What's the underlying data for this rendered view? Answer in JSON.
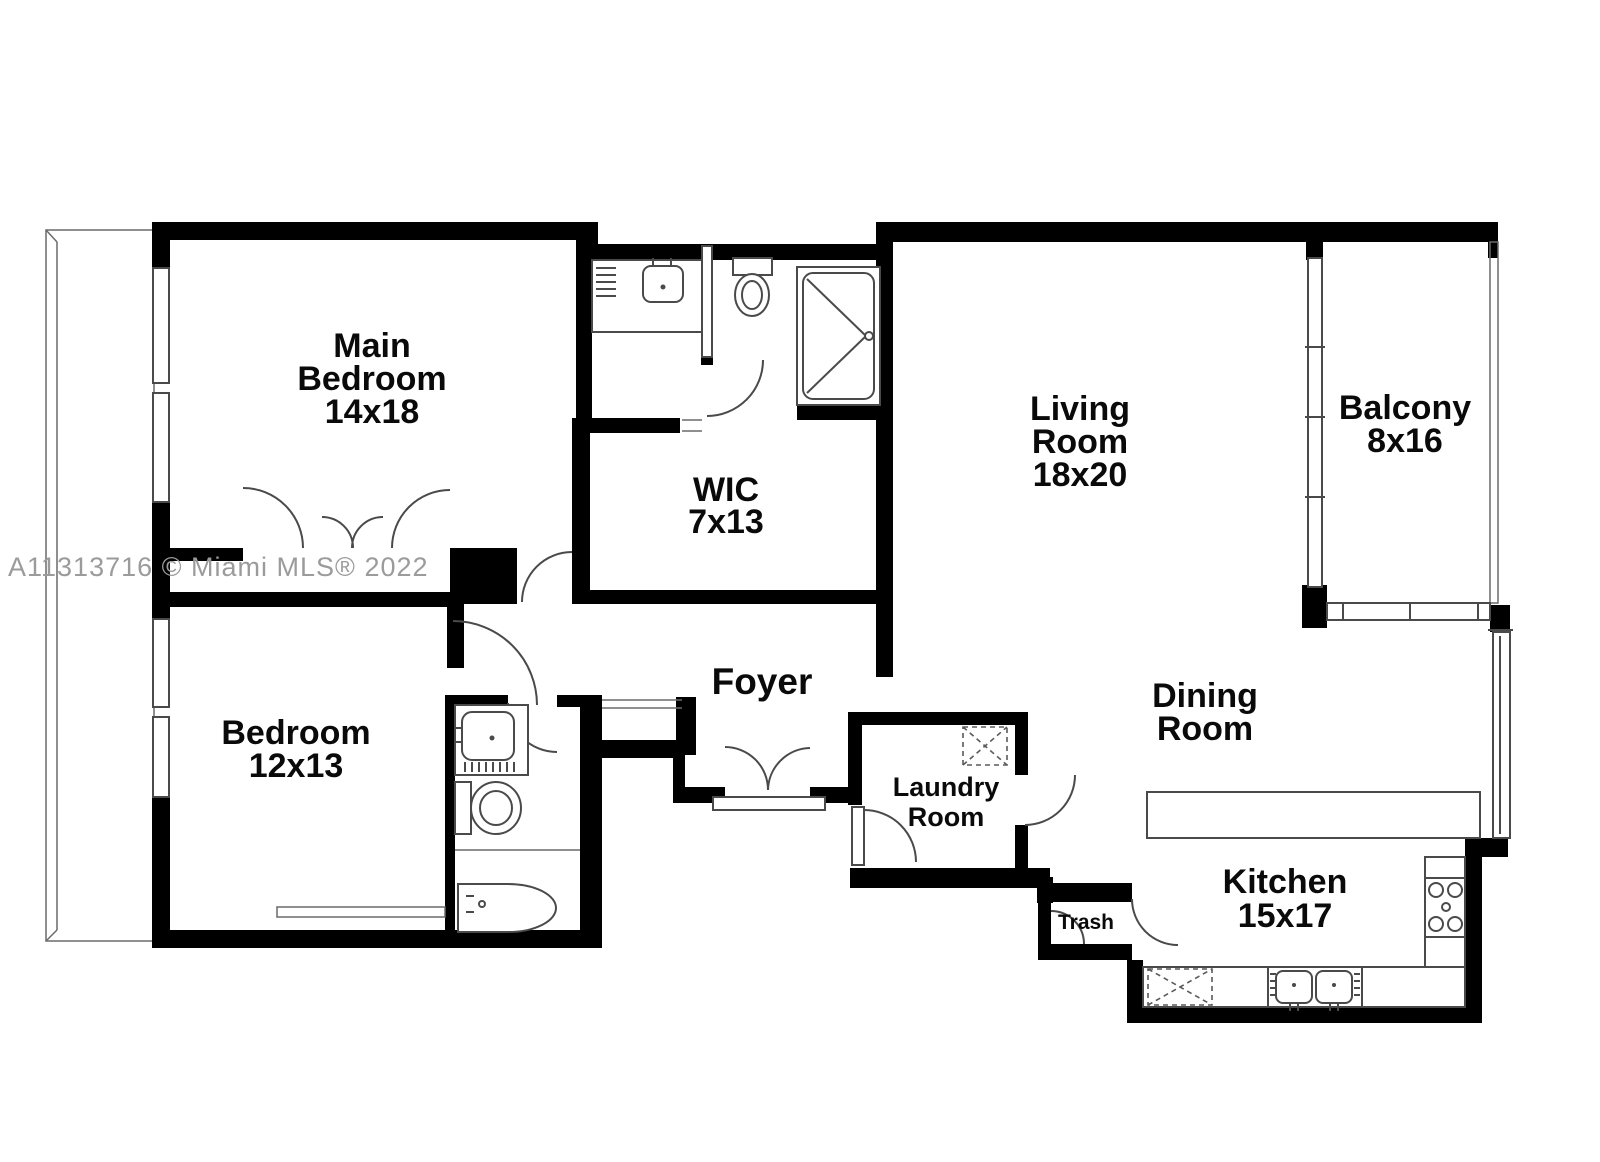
{
  "watermark": "A11313716 © Miami MLS® 2022",
  "rooms": {
    "main_bedroom": {
      "line1": "Main",
      "line2": "Bedroom",
      "dims": "14x18"
    },
    "wic": {
      "name": "WIC",
      "dims": "7x13"
    },
    "living_room": {
      "line1": "Living",
      "line2": "Room",
      "dims": "18x20"
    },
    "balcony": {
      "name": "Balcony",
      "dims": "8x16"
    },
    "bedroom": {
      "name": "Bedroom",
      "dims": "12x13"
    },
    "foyer": {
      "name": "Foyer"
    },
    "laundry_room": {
      "line1": "Laundry",
      "line2": "Room"
    },
    "dining_room": {
      "line1": "Dining",
      "line2": "Room"
    },
    "kitchen": {
      "name": "Kitchen",
      "dims": "15x17"
    },
    "trash": {
      "name": "Trash"
    }
  },
  "icons": [
    "shower-icon",
    "toilet-icon",
    "sink-icon",
    "bathtub-icon",
    "washer-dryer-icon",
    "stove-icon",
    "kitchen-sink-icon",
    "double-entry-door-icon",
    "door-swing-icon",
    "bifold-closet-door-icon"
  ],
  "colors": {
    "walls": "#000000",
    "fixture_lines": "#4a4a4a",
    "labels": "#0a0a0a",
    "watermark": "#9b9b9b",
    "background": "#ffffff"
  }
}
